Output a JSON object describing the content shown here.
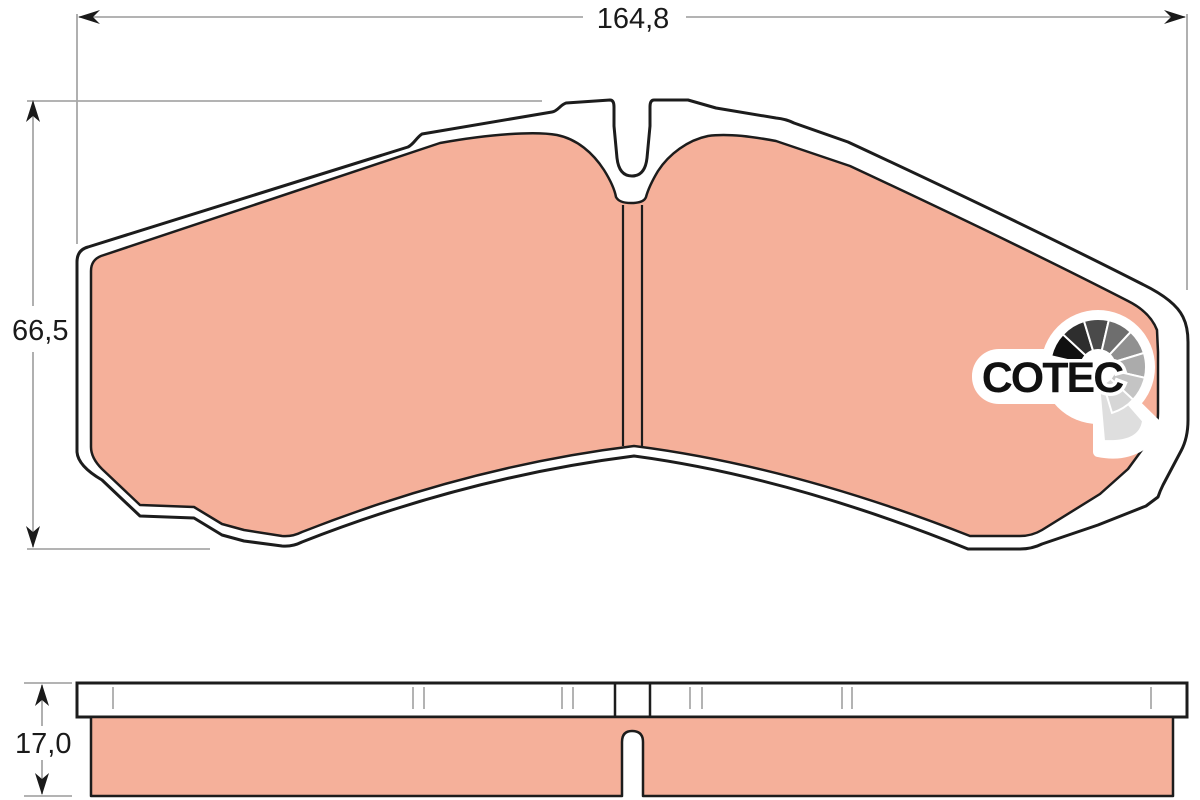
{
  "drawing": {
    "dimensions": {
      "width_label": "164,8",
      "height_label": "66,5",
      "thickness_label": "17,0"
    },
    "logo": {
      "text": "COTEC"
    },
    "colors": {
      "friction_material": "#f5b09a",
      "outline": "#1c1c1c",
      "dimension_line": "#a8a8a8",
      "tick": "#b3b3b3",
      "background": "#ffffff",
      "logo_text": "#111111",
      "fan_shades": [
        "#101010",
        "#2e2e2e",
        "#4a4a4a",
        "#6e6e6e",
        "#909090",
        "#ababab",
        "#c4c4c4",
        "#d6d6d6"
      ],
      "fan_tail": "#dedede"
    },
    "fan": {
      "cx": 1098,
      "cy": 367,
      "r_outer": 48,
      "r_inner": 17,
      "start_angle": 193,
      "step": 30
    }
  }
}
